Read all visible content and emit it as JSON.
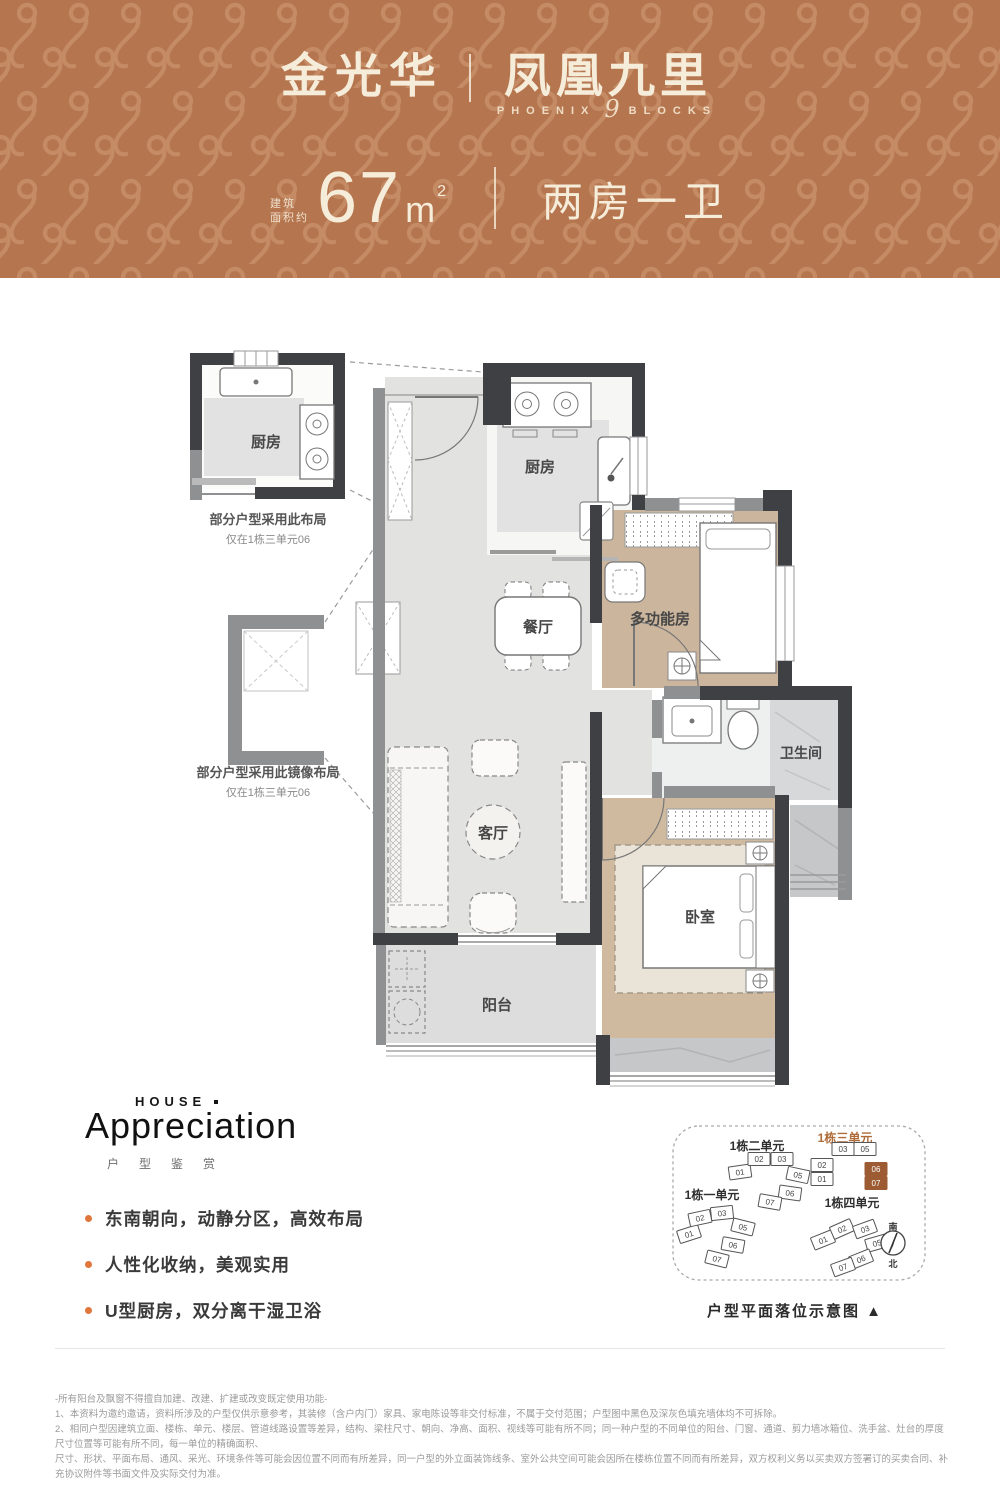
{
  "header": {
    "brand": "金光华",
    "project": "凤凰九里",
    "en_prefix": "PHOENIX",
    "en_num": "9",
    "en_suffix": "BLOCKS",
    "area_label_1": "建筑",
    "area_label_2": "面积约",
    "area_value": "67",
    "area_unit": "m",
    "area_sup": "2",
    "layout_type": "两房一卫",
    "bg_color": "#b5764f",
    "pattern_color": "#c8906a",
    "text_color": "#f6ecda"
  },
  "floor_plan": {
    "rooms": {
      "kitchen_inset": "厨房",
      "kitchen": "厨房",
      "dining": "餐厅",
      "multifunction": "多功能房",
      "bathroom": "卫生间",
      "living": "客厅",
      "bedroom": "卧室",
      "balcony": "阳台"
    },
    "inset_top_caption_1": "部分户型采用此布局",
    "inset_top_caption_2": "仅在1栋三单元06",
    "inset_mirror_caption_1": "部分户型采用此镜像布局",
    "inset_mirror_caption_2": "仅在1栋三单元06",
    "colors": {
      "wall_dark": "#3e4043",
      "wall_gray": "#8e9092",
      "tile": "#e2e3e1",
      "wood": "#cbb59c",
      "marble": "#c6c7c9"
    }
  },
  "appreciation": {
    "en_label": "HOUSE",
    "en_title": "Appreciation",
    "cn_title": "户型鉴赏",
    "bullet_color": "#e0763c",
    "bullets": [
      "东南朝向，动静分区，高效布局",
      "人性化收纳，美观实用",
      "U型厨房，双分离干湿卫浴"
    ]
  },
  "site_plan": {
    "clusters": [
      {
        "name": "1栋一单元",
        "units": [
          "01",
          "02",
          "03",
          "05",
          "06",
          "07"
        ],
        "highlight": []
      },
      {
        "name": "1栋二单元",
        "units": [
          "01",
          "02",
          "03",
          "05",
          "06",
          "07"
        ],
        "highlight": []
      },
      {
        "name": "1栋三单元",
        "units": [
          "01",
          "02",
          "03",
          "05",
          "06",
          "07"
        ],
        "highlight": [
          "06",
          "07"
        ]
      },
      {
        "name": "1栋四单元",
        "units": [
          "01",
          "02",
          "03",
          "05",
          "06",
          "07"
        ],
        "highlight": []
      }
    ],
    "highlight_color": "#9c5b33",
    "compass_top": "南",
    "compass_bottom": "北",
    "caption": "户型平面落位示意图 ▲"
  },
  "disclaimer": {
    "lines": [
      "-所有阳台及飘窗不得擅自加建、改建、扩建或改变既定使用功能-",
      "1、本资料为邀约邀请，资料所涉及的户型仅供示意参考，其装修（含户内门）家具、家电陈设等非交付标准，不属于交付范围；户型图中黑色及深灰色填充墙体均不可拆除。",
      "2、相同户型因建筑立面、楼栋、单元、楼层、管道线路设置等差异，结构、梁柱尺寸、朝向、净高、面积、视线等可能有所不同；同一种户型的不同单位的阳台、门窗、通道、剪力墙冰箱位、洗手盆、灶台的厚度尺寸位置等可能有所不同，每一单位的精确面积、",
      "尺寸、形状、平面布局、通风、采光、环境条件等可能会因位置不同而有所差异，同一户型的外立面装饰线条、室外公共空间可能会因所在楼栋位置不同而有所差异，双方权利义务以买卖双方签署订的买卖合同、补充协议附件等书面文件及实际交付为准。"
    ]
  }
}
